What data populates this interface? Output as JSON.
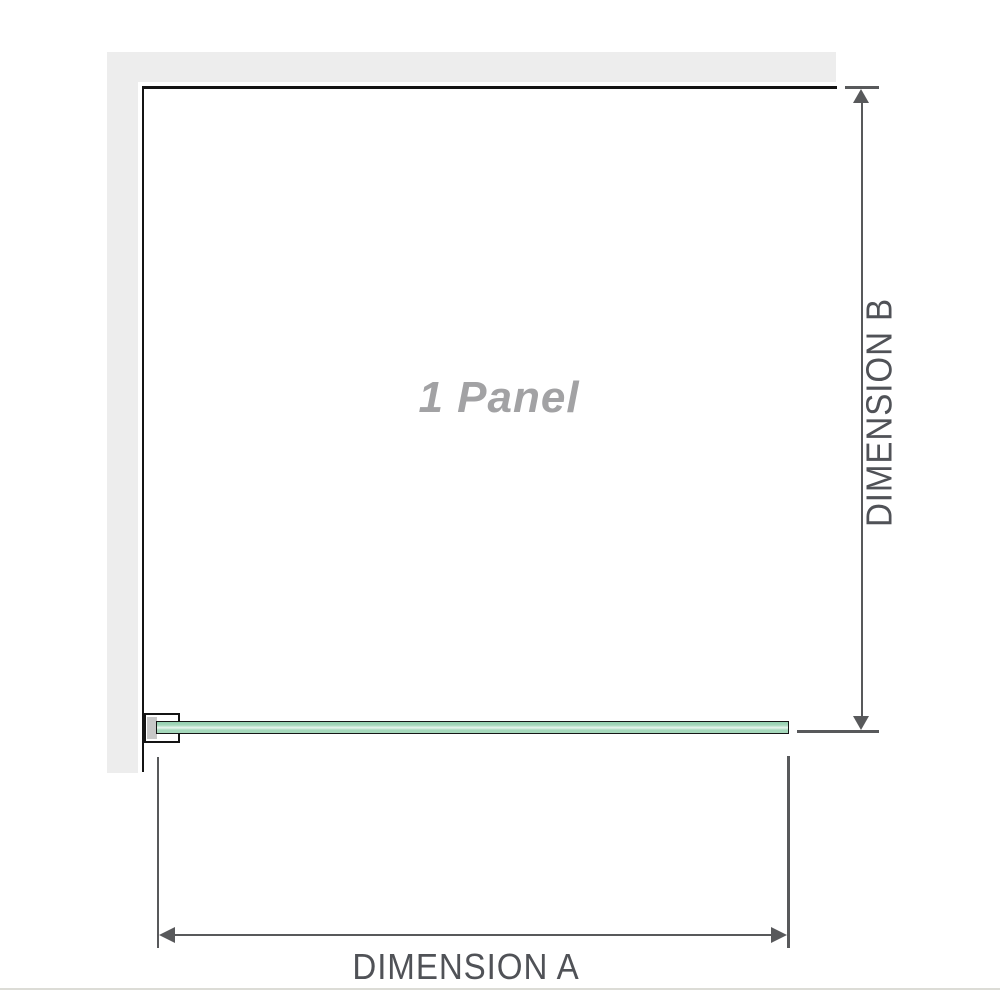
{
  "diagram": {
    "type": "shower-screen-dimension-diagram",
    "panel_label": "1 Panel",
    "dimension_a_label": "DIMENSION A",
    "dimension_b_label": "DIMENSION B",
    "colors": {
      "wall": "#ededed",
      "panel_border": "#141414",
      "glass_outline": "#161616",
      "glass_green": "#a5d8bb",
      "glass_dark": "#93d0b0",
      "glass_highlight": "#e9f6ef",
      "bracket_fill": "#c7c7c7",
      "dim_line": "#58595b",
      "label_text": "#505257",
      "panel_label_text": "#a2a2a4",
      "baseline": "#dcdcd6"
    }
  }
}
